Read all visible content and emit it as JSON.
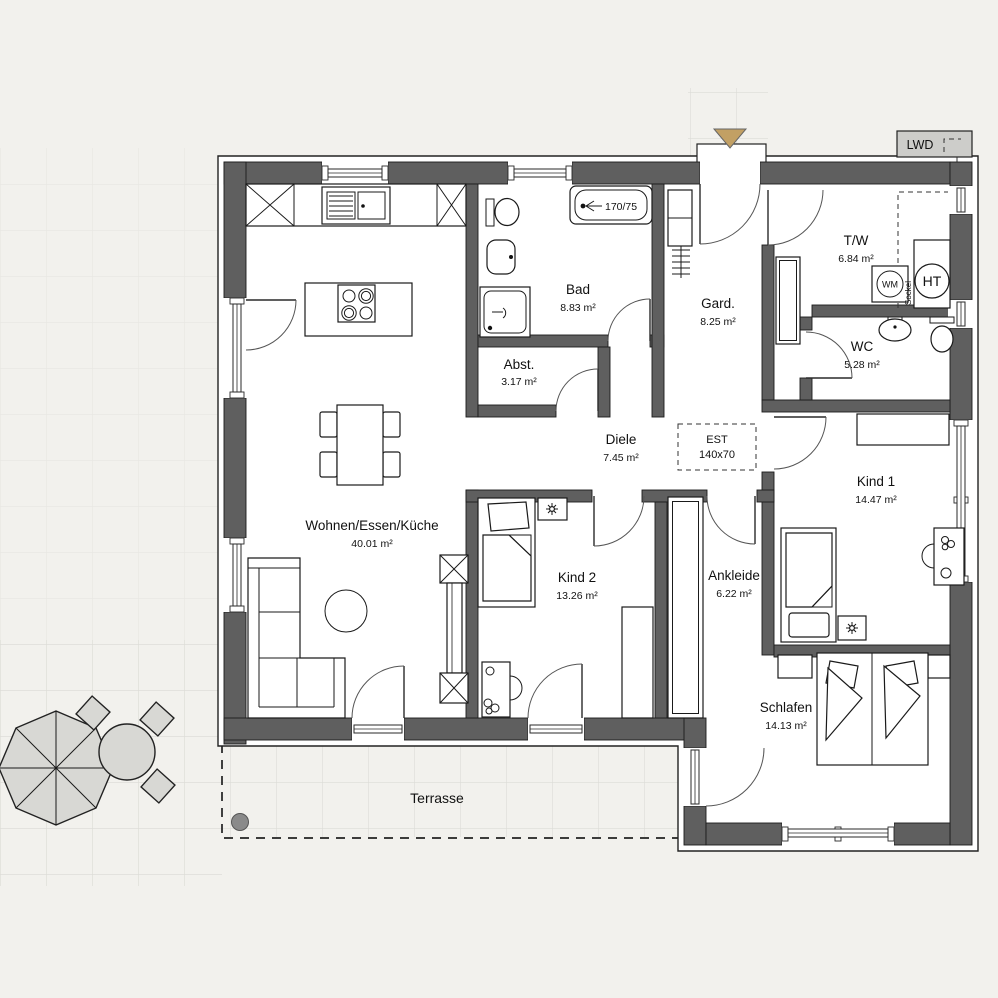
{
  "plan": {
    "rooms": [
      {
        "name": "Wohnen/Essen/Küche",
        "area": "40.01 m²"
      },
      {
        "name": "Bad",
        "area": "8.83 m²"
      },
      {
        "name": "Abst.",
        "area": "3.17 m²"
      },
      {
        "name": "Gard.",
        "area": "8.25 m²"
      },
      {
        "name": "T/W",
        "area": "6.84 m²"
      },
      {
        "name": "WC",
        "area": "5.28 m²"
      },
      {
        "name": "Diele",
        "area": "7.45 m²"
      },
      {
        "name": "Kind 1",
        "area": "14.47 m²"
      },
      {
        "name": "Kind 2",
        "area": "13.26 m²"
      },
      {
        "name": "Ankleide",
        "area": "6.22 m²"
      },
      {
        "name": "Schlafen",
        "area": "14.13 m²"
      }
    ],
    "outdoor": {
      "terrace_label": "Terrasse"
    },
    "annotations": {
      "est_line1": "EST",
      "est_line2": "140x70",
      "tub_size": "170/75",
      "lwd": "LWD",
      "wm": "WM",
      "ht": "HT",
      "sockel": "Sockel"
    },
    "colors": {
      "wall": "#5f5f5f",
      "background": "#f2f1ed",
      "outdoor_furniture": "#d8d8d4",
      "terrace_marker": "#8a8a8a",
      "entrance_marker": "#c2a064"
    }
  }
}
